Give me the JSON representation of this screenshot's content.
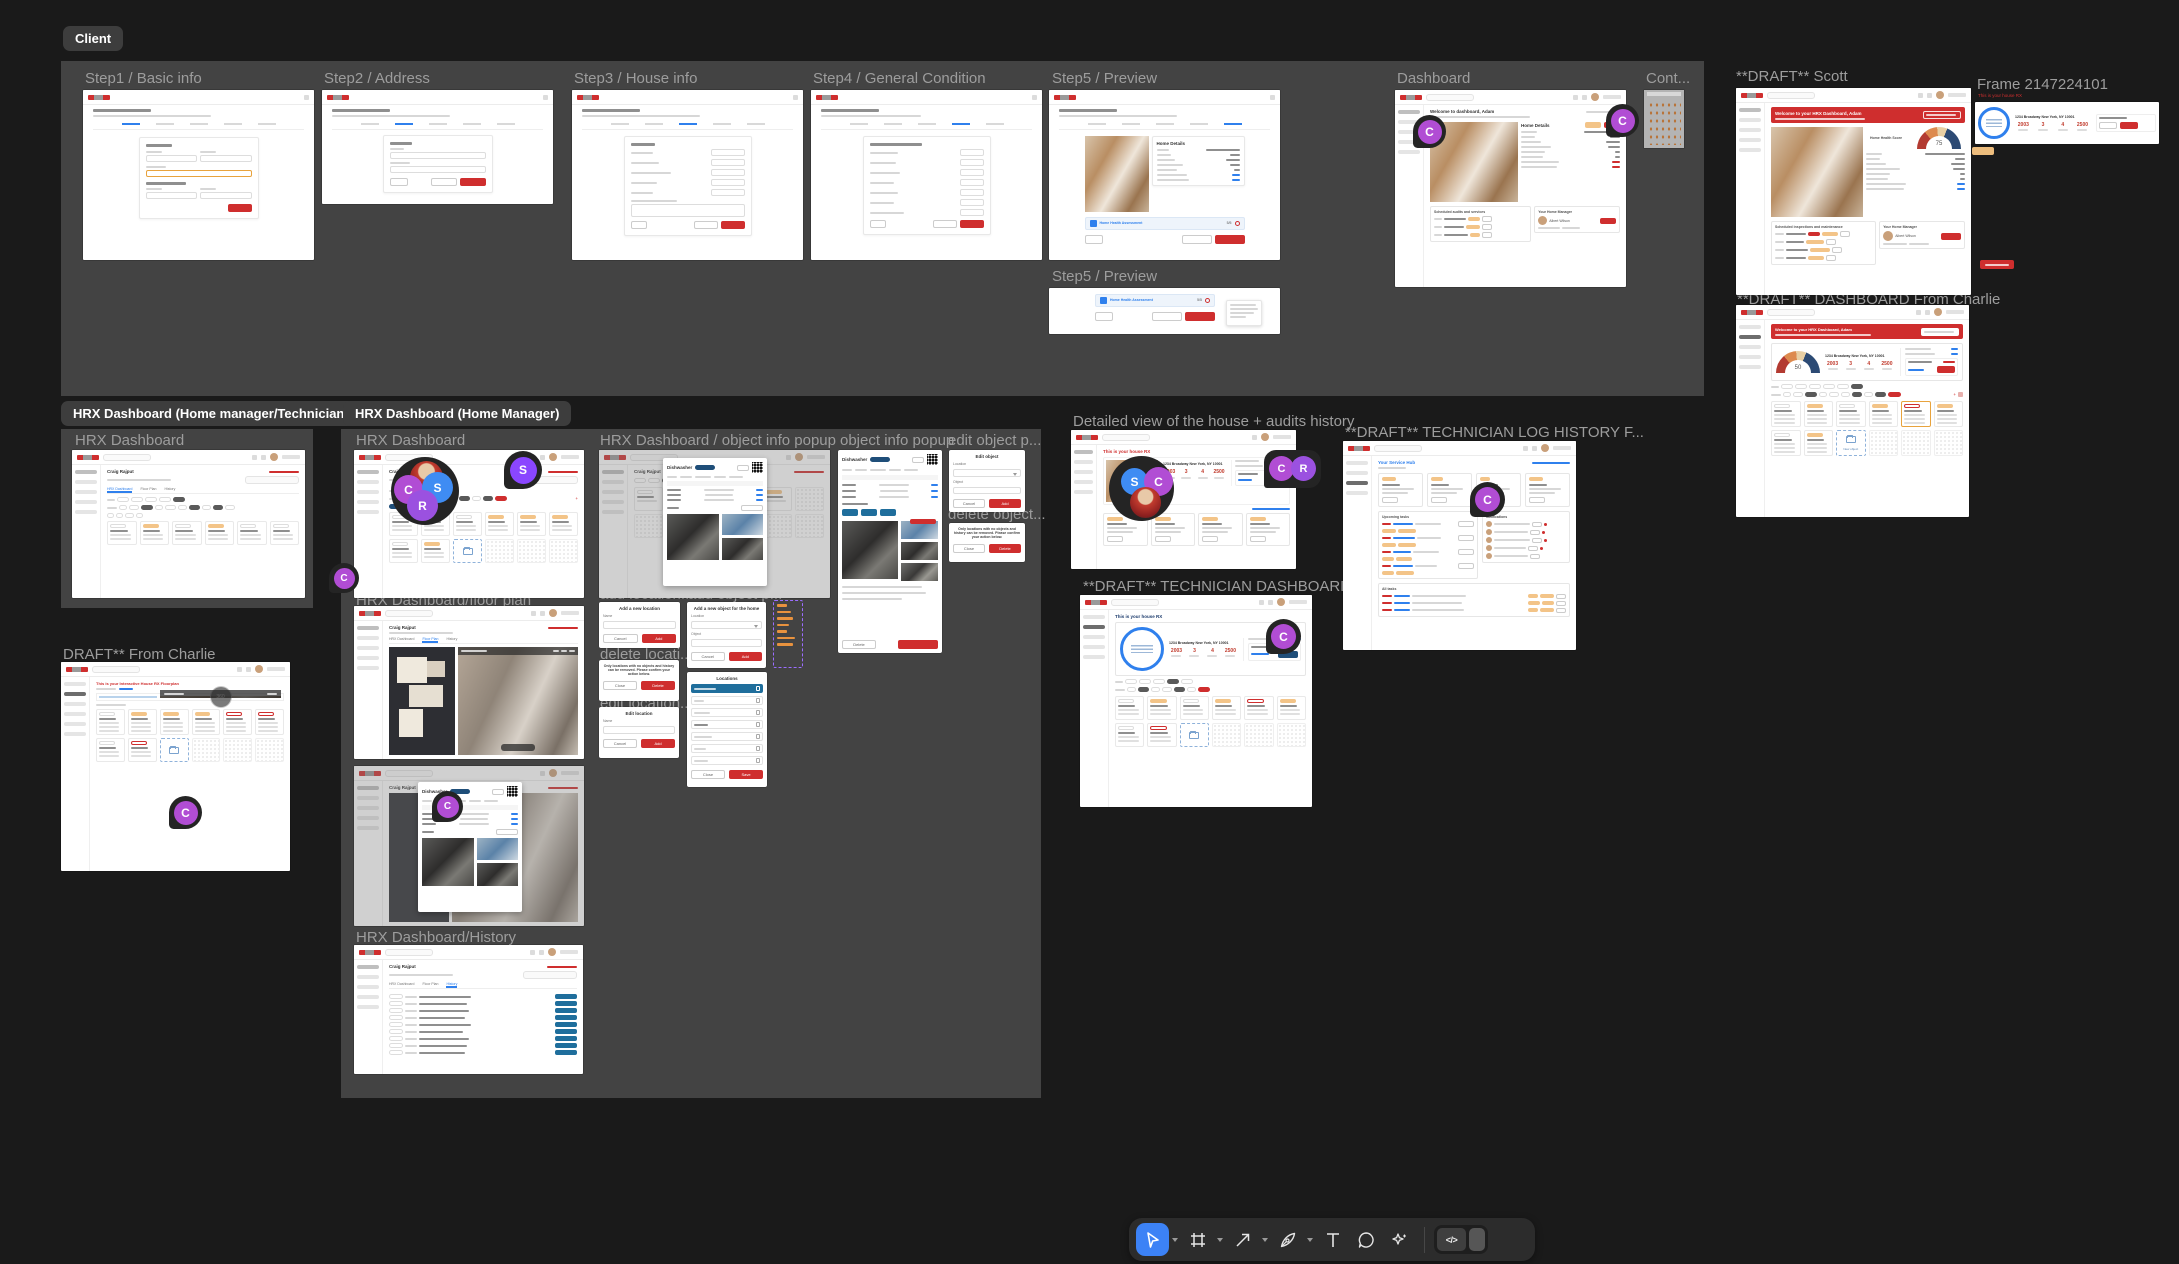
{
  "badges": {
    "client": "Client",
    "hm_tech": "HRX Dashboard (Home manager/Technician)",
    "hm": "HRX Dashboard (Home Manager)"
  },
  "frames": {
    "step1": {
      "label": "Step1 / Basic info"
    },
    "step2": {
      "label": "Step2 / Address"
    },
    "step3": {
      "label": "Step3 / House info"
    },
    "step4": {
      "label": "Step4 / General Condition"
    },
    "step5": {
      "label": "Step5 / Preview"
    },
    "dashboard": {
      "label": "Dashboard"
    },
    "cont": {
      "label": "Cont..."
    },
    "step5b": {
      "label": "Step5 / Preview"
    },
    "draft_scott": {
      "label": "**DRAFT** Scott"
    },
    "frame_214": {
      "label": "Frame 2147224101"
    },
    "draft_dash_charlie": {
      "label": "**DRAFT** DASHBOARD From Charlie"
    },
    "hrx_tech": {
      "label": "HRX Dashboard"
    },
    "draft_from_charlie": {
      "label": "DRAFT** From Charlie"
    },
    "hrx_hm": {
      "label": "HRX Dashboard"
    },
    "hrx_floorplan": {
      "label": "HRX Dashboard/floor plan"
    },
    "hrx_history": {
      "label": "HRX Dashboard/History"
    },
    "hrx_object_info": {
      "label": "HRX Dashboard / object info popup"
    },
    "add_location": {
      "label": "add location..."
    },
    "delete_location": {
      "label": "delete locati..."
    },
    "edit_location": {
      "label": "edit location..."
    },
    "add_object": {
      "label": "add object p..."
    },
    "object_info": {
      "label": "object info popup"
    },
    "edit_object": {
      "label": "edit object p..."
    },
    "delete_object": {
      "label": "delete object..."
    },
    "detailed_view": {
      "label": "Detailed view of the house + audits history"
    },
    "draft_tech_dash": {
      "label": "**DRAFT** TECHNICIAN DASHBOARD Fr..."
    },
    "draft_tech_log": {
      "label": "**DRAFT** TECHNICIAN LOG HISTORY F..."
    }
  },
  "mock": {
    "banner_welcome": "Welcome to your HRX Dashboard, Adam",
    "welcome_dash": "Welcome to dashboard, Adam",
    "this_is_house": "This is your house RX",
    "interactive_floorplan": "This is your Interactive House RX Floorplan",
    "service_hub": "Your Service Hub",
    "address": "1234 Broadway New York, NY 10001",
    "stats": [
      "2003",
      "3",
      "4",
      "2500"
    ],
    "gauge_scott": "75",
    "gauge_charlie": "50",
    "craig": "Craig Rajput",
    "albert": "Albert Wilson",
    "home_details": "Home Details",
    "home_health_score": "Home Health Score",
    "home_health_assessment": "Home Health Assessment",
    "score": "5/5",
    "your_home_manager": "Your Home Manager",
    "sched_audits": "Scheduled audits and services",
    "sched_inspections": "Scheduled inspections and maintenance",
    "upcoming_tasks": "Upcoming tasks",
    "notifications": "Notifications",
    "all_tasks": "All tasks",
    "dishwasher": "Dishwasher",
    "badge_360": "360",
    "tabs": [
      "HRX Dashboard",
      "Floor Plan",
      "History"
    ],
    "new_object": "New object"
  },
  "popups": {
    "add_location_title": "Add a new location",
    "add_object_title": "Add a new object for the home",
    "locations_title": "Locations",
    "edit_location_title": "Edit location",
    "edit_object_title": "Edit object",
    "delete_confirm": "Only locations with no objects and history can be removed. Please confirm your action below.",
    "name_label": "Name",
    "location_label": "Location",
    "object_label": "Object",
    "cancel": "Cancel",
    "add": "Add",
    "close": "Close",
    "save": "Save",
    "delete": "Delete"
  },
  "avatars": {
    "c": "C",
    "s": "S",
    "r": "R"
  },
  "toolbar": {
    "dev_icon": "</>"
  },
  "misc": {
    "component_ellipsis": "..."
  },
  "colors": {
    "canvas_bg": "#1a1a1a",
    "section_bg": "#434343",
    "accent_red": "#cf2e2e",
    "accent_blue": "#2f80ed",
    "dark_blue_button": "#1f6e9c",
    "orange_pill": "#f3c488",
    "avatar_purple_c": "#b14dd4",
    "avatar_violet_r": "#9b51e0",
    "avatar_blue_s": "#3f8cf3",
    "avatar_purple_s": "#8a46ff",
    "tool_selected": "#3c82f6"
  }
}
